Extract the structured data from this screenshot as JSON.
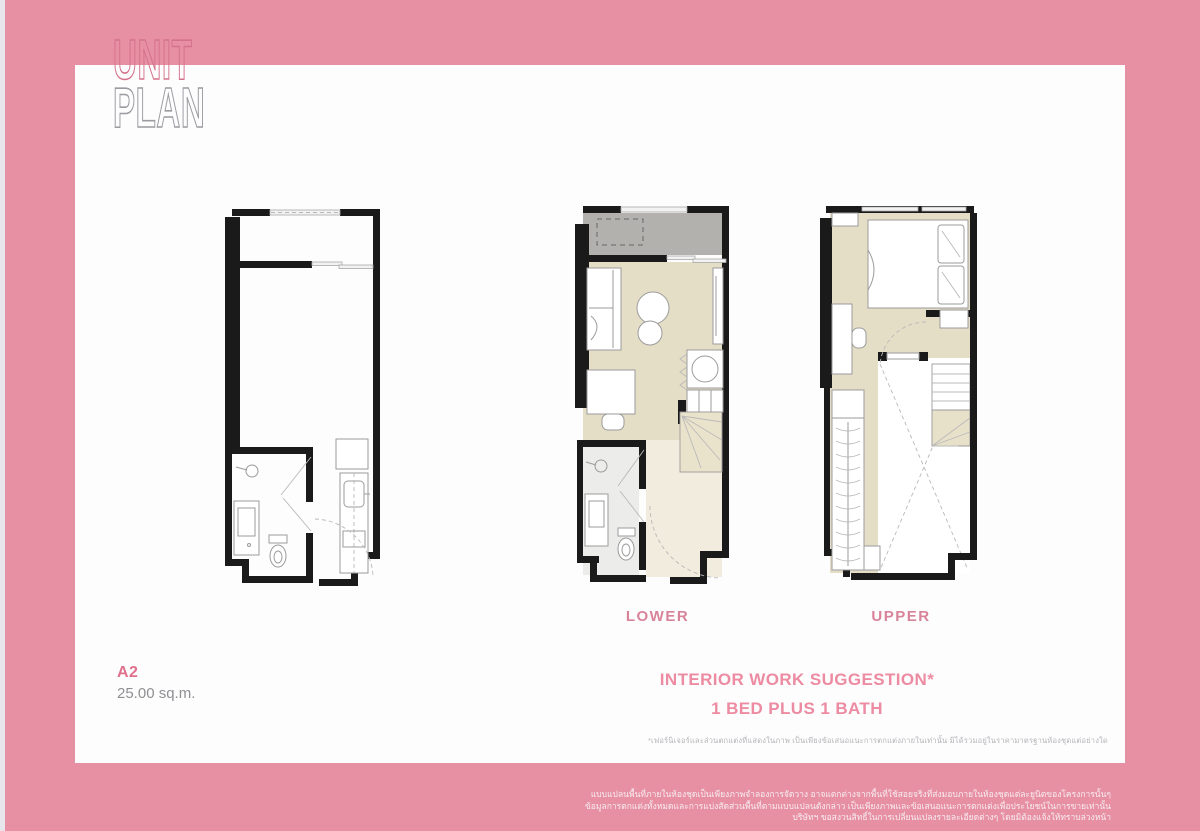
{
  "header": {
    "title_top": "UNIT",
    "title_bottom": "PLAN"
  },
  "unit_info": {
    "code": "A2",
    "area": "25.00 sq.m."
  },
  "plan_labels": {
    "lower": "LOWER",
    "upper": "UPPER"
  },
  "suggestion": {
    "heading": "INTERIOR WORK SUGGESTION*",
    "subheading": "1 BED PLUS 1 BATH"
  },
  "footnote": "*เฟอร์นิเจอร์และส่วนตกแต่งที่แสดงในภาพ เป็นเพียงข้อเสนอแนะการตกแต่งภายในเท่านั้น มิได้รวมอยู่ในราคามาตรฐานห้องชุดแต่อย่างใด",
  "footer_disclaimer": {
    "lines": [
      "แบบแปลนพื้นที่ภายในห้องชุดเป็นเพียงภาพจำลองการจัดวาง อาจแตกต่างจากพื้นที่ใช้สอยจริงที่ส่งมอบภายในห้องชุดแต่ละยูนิตของโครงการนั้นๆ",
      "ข้อมูลการตกแต่งทั้งหมดและการแบ่งสัดส่วนพื้นที่ตามแบบแปลนดังกล่าว เป็นเพียงภาพและข้อเสนอแนะการตกแต่งเพื่อประโยชน์ในการขายเท่านั้น",
      "บริษัทฯ ขอสงวนสิทธิ์ในการเปลี่ยนแปลงรายละเอียดต่างๆ โดยมิต้องแจ้งให้ทราบล่วงหน้า"
    ]
  },
  "colors": {
    "frame_pink": "#e78fa3",
    "accent_pink": "#e0718c",
    "label_pink": "#d8839a",
    "floor_beige": "#e5dec7",
    "balcony_gray": "#b2b1ae",
    "wall_black": "#1a1a1a"
  }
}
